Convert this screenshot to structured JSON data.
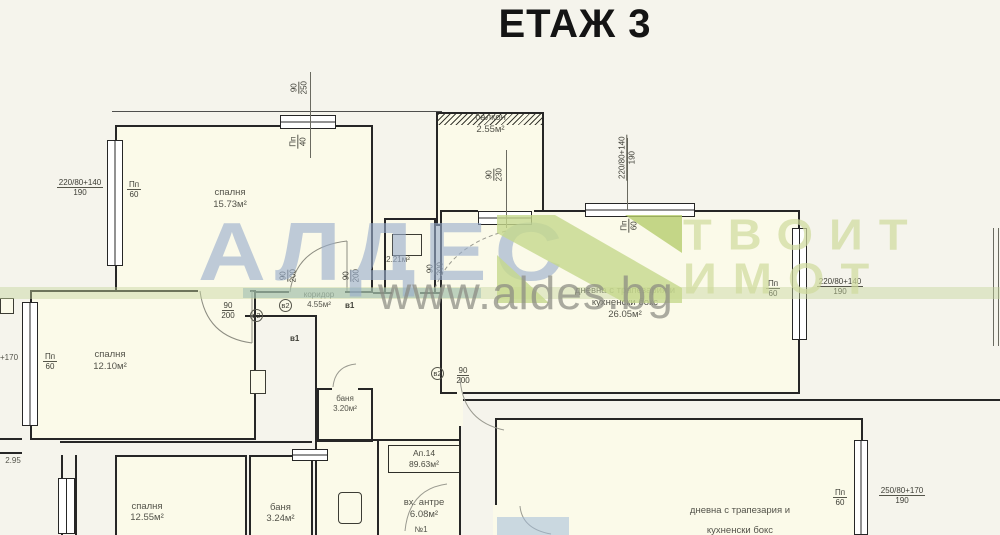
{
  "title": "ЕТАЖ 3",
  "watermark": {
    "brand": "АЛДЕС",
    "right_line1": "ТВОИТ",
    "right_line2": "ИМОТ",
    "url": "www.aldes.bg",
    "brand_color": "#98add0",
    "logo_green": "#c6d88c",
    "accent_green": "#b7cd6e"
  },
  "apartment": {
    "label": "Ап.14",
    "area": "89.63м²"
  },
  "rooms": {
    "bedroom1": {
      "name": "спалня",
      "area": "15.73м²"
    },
    "balcony": {
      "name": "балкон",
      "area": "2.55м²"
    },
    "living": {
      "name_line1": "дневна с трапезария и",
      "name_line2": "кухненски бокс",
      "area": "26.05м²"
    },
    "corridor": {
      "name": "коридор",
      "area": "4.55м²"
    },
    "bedroom2": {
      "name": "спалня",
      "area": "12.10м²"
    },
    "wc": {
      "area": "2.21м²"
    },
    "bath1": {
      "name": "баня",
      "area": "3.20м²"
    },
    "bedroom3": {
      "name": "спалня",
      "area": "12.55м²"
    },
    "bath2": {
      "name": "баня",
      "area": "3.24м²"
    },
    "entry": {
      "name": "вх. антре",
      "area": "6.08м²",
      "note": "№1"
    },
    "living2": {
      "name_line1": "дневна с трапезария и",
      "name_line2": "кухненски бокс"
    }
  },
  "dims": {
    "win1_w": "220/80+140",
    "win1_h": "190",
    "win3_w": "250/80+170",
    "win3_h": "190",
    "pp": "Пп",
    "h60": "60",
    "h40": "40",
    "d90": "90",
    "d250": "250",
    "d230": "230",
    "d200": "200",
    "plus170": "+170",
    "len295": "2.95",
    "v1": "в1",
    "v2": "в2"
  }
}
